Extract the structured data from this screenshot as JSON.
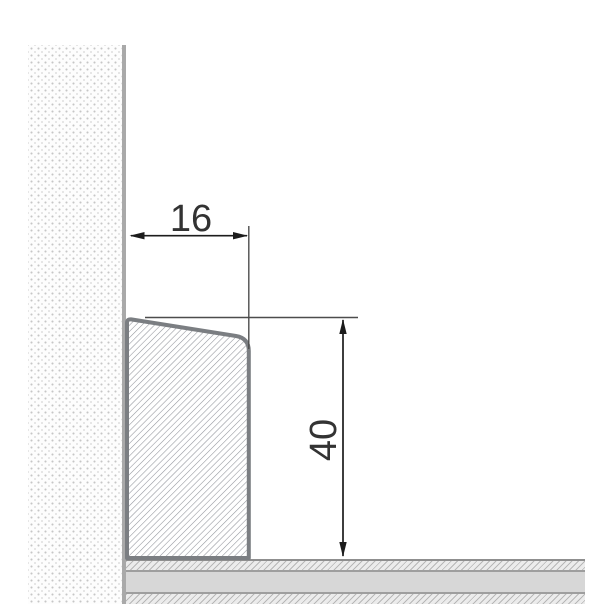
{
  "drawing": {
    "labels": {
      "width_mm": "16",
      "height_mm": "40"
    },
    "colors": {
      "profile_outline": "#7b7e82",
      "profile_hatch": "#90939a",
      "dimension_line": "#1c1c1c",
      "extension_line": "#4d4d4d",
      "label_text": "#333333",
      "wall_edge": "#a9a9a9",
      "floor_solid": "#d7d7d7",
      "floor_border": "#8f8f8f"
    }
  }
}
